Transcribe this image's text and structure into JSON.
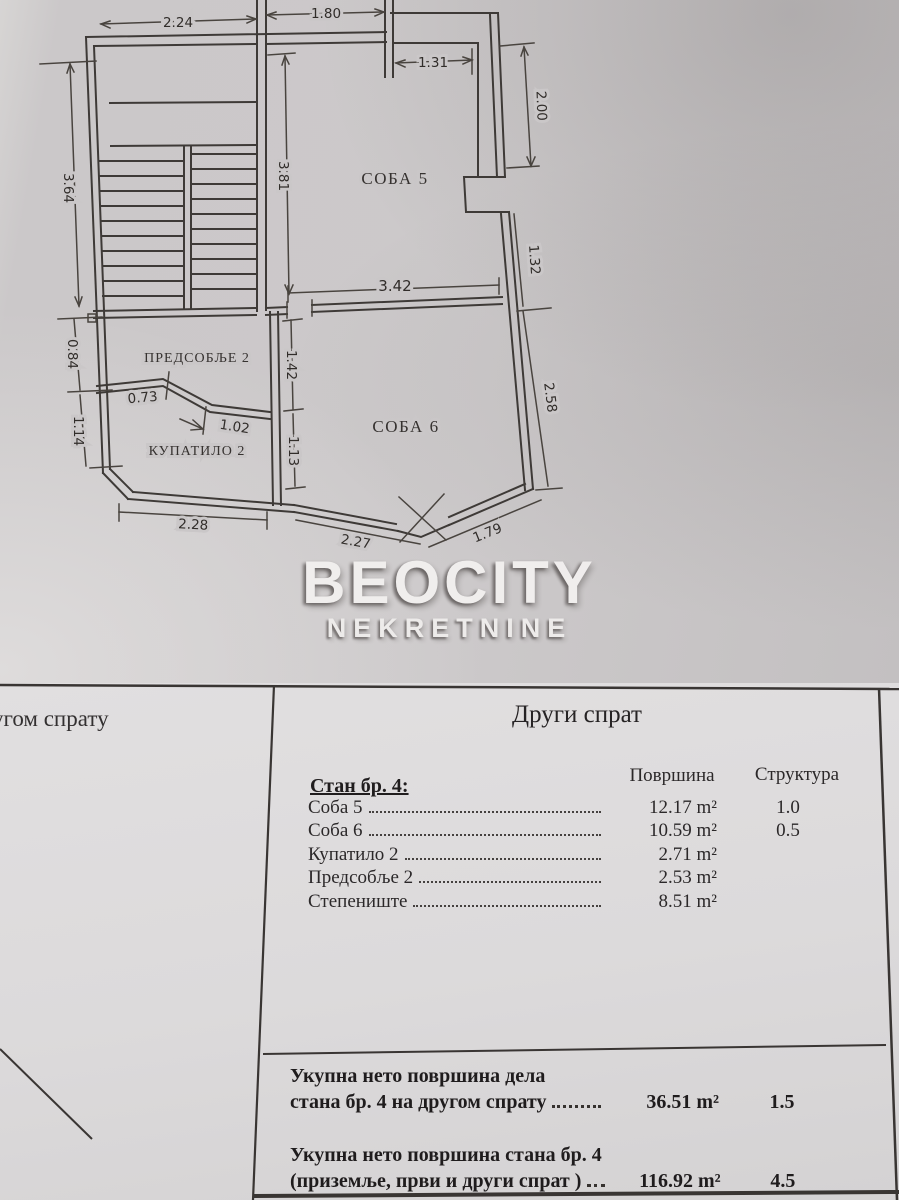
{
  "plan": {
    "rooms": {
      "room5": "СОБА 5",
      "room6": "СОБА 6",
      "hallway": "ПРЕДСОБЉЕ 2",
      "bathroom": "КУПАТИЛО 2"
    },
    "dims": {
      "top_left": "2.24",
      "top_right": "1.80",
      "niche": "1.31",
      "right_upper": "2.00",
      "left_upper": "3.64",
      "soba5_height": "3.81",
      "right_mid": "1.32",
      "mid_width": "3.42",
      "right_lower": "2.58",
      "left_mid": "0.84",
      "hall_height": "1.42",
      "bath_top": "0.73",
      "bath_diag": "1.02",
      "left_lower": "1.14",
      "bath_height": "1.13",
      "bottom_left": "2.28",
      "bottom_mid": "2.27",
      "bottom_right": "1.79"
    }
  },
  "watermark": {
    "line1": "BEOCITY",
    "line2": "NEKRETNINE"
  },
  "colors": {
    "paper_photo": "#cbc8c9",
    "paper_scan": "#dddbdc",
    "ink": "#3e3a37"
  },
  "table": {
    "left_note": "угом спрату",
    "title": "Други спрат",
    "apartment_label": "Стан бр. 4:",
    "col_area": "Површина",
    "col_structure": "Структура",
    "rows": [
      {
        "label": "Соба 5",
        "area": "12.17 m²",
        "structure": "1.0"
      },
      {
        "label": "Соба 6",
        "area": "10.59 m²",
        "structure": "0.5"
      },
      {
        "label": "Купатило 2",
        "area": "2.71 m²",
        "structure": ""
      },
      {
        "label": "Предсобље 2",
        "area": "2.53 m²",
        "structure": ""
      },
      {
        "label": "Степениште",
        "area": "8.51 m²",
        "structure": ""
      }
    ],
    "totals": [
      {
        "line1": "Укупна нето површина дела",
        "line2": "стана бр. 4 на другом спрату",
        "area": "36.51 m²",
        "structure": "1.5"
      },
      {
        "line1": "Укупна нето површина стана бр. 4",
        "line2": "(приземље, први и други спрат )",
        "area": "116.92 m²",
        "structure": "4.5"
      }
    ]
  }
}
